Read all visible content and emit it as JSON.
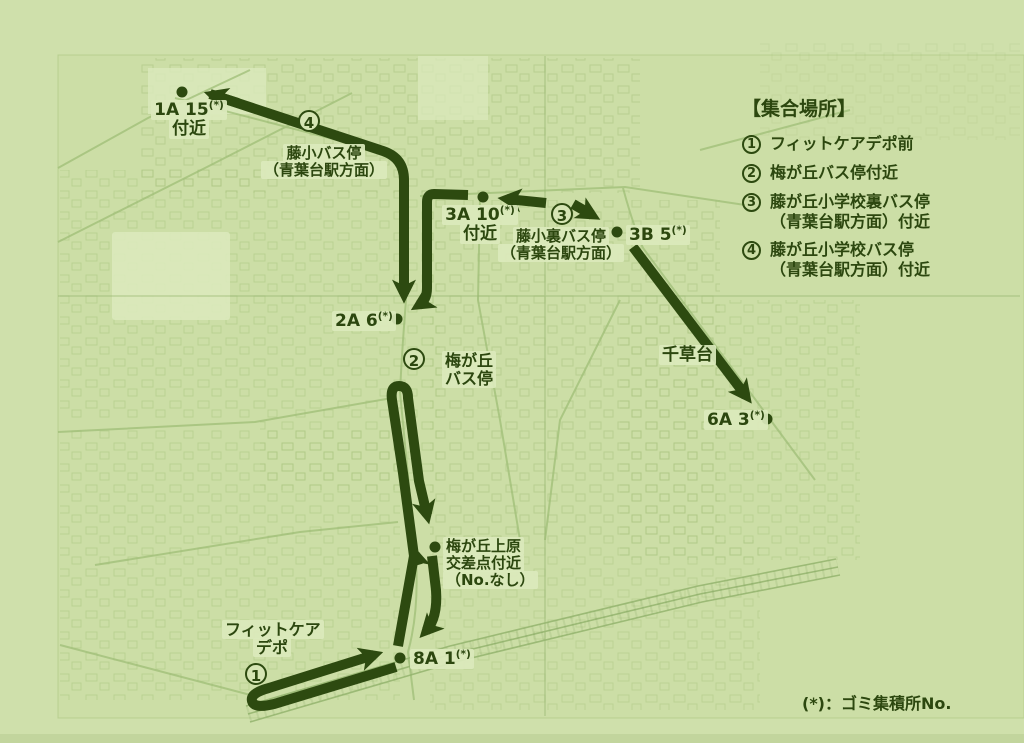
{
  "colors": {
    "background": "#cfe0ab",
    "route": "#2d4a10",
    "ink": "#2c470f",
    "map_lines": "#a0bf78"
  },
  "map": {
    "star": "(*)",
    "markers": {
      "n1": "1",
      "n2": "2",
      "n3": "3",
      "n4": "4"
    },
    "spot_1a15": {
      "id": "1A 15",
      "near": "付近"
    },
    "spot_3a10": {
      "id": "3A 10",
      "near": "付近"
    },
    "spot_3b5": {
      "id": "3B 5"
    },
    "spot_2a6": {
      "id": "2A 6"
    },
    "spot_6a3": {
      "id": "6A 3"
    },
    "spot_8a1": {
      "id": "8A 1"
    },
    "intersection": {
      "line1": "梅が丘上原",
      "line2": "交差点付近",
      "line3": "（No.なし）"
    },
    "stops": {
      "fujisho": {
        "line1": "藤小バス停",
        "line2": "（青葉台駅方面）"
      },
      "fujishoura": {
        "line1": "藤小裏バス停",
        "line2": "（青葉台駅方面）"
      },
      "umegaoka": {
        "line1": "梅が丘",
        "line2": "バス停"
      },
      "chigusadai": {
        "name": "千草台"
      },
      "fitcare": {
        "line1": "フィットケア",
        "line2": "デポ"
      }
    }
  },
  "legend": {
    "title": "【集合場所】",
    "items": [
      {
        "num": "1",
        "lines": [
          "フィットケアデポ前"
        ]
      },
      {
        "num": "2",
        "lines": [
          "梅が丘バス停付近"
        ]
      },
      {
        "num": "3",
        "lines": [
          "藤が丘小学校裏バス停",
          "（青葉台駅方面）付近"
        ]
      },
      {
        "num": "4",
        "lines": [
          "藤が丘小学校バス停",
          "（青葉台駅方面）付近"
        ]
      }
    ]
  },
  "footnote": {
    "text": "(*)：ゴミ集積所No."
  }
}
